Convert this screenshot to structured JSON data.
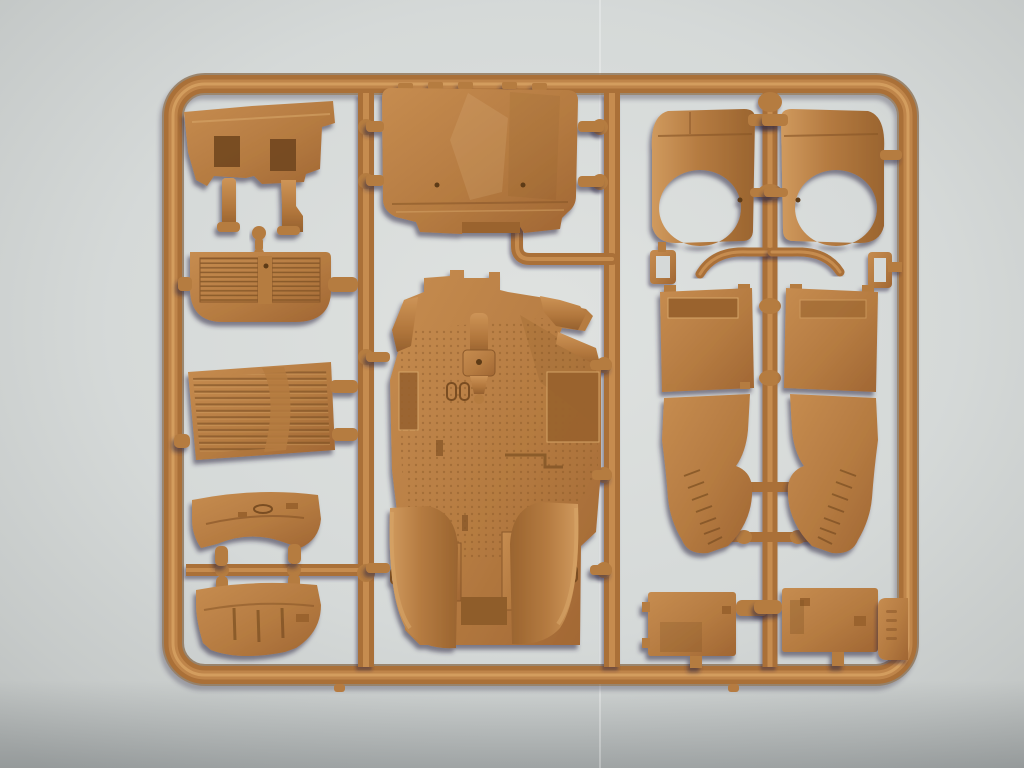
{
  "scene": {
    "subject": "tan plastic model-kit sprue (parts tree) photographed on light grey paper",
    "columns": 3
  },
  "colors": {
    "background": "#cfd3d2",
    "background_light": "#dfe2e0",
    "background_dark": "#b9bdbc",
    "plastic_base": "#b57b41",
    "plastic_mid": "#aa7038",
    "plastic_light": "#cd9457",
    "plastic_highlight": "#d6a162",
    "plastic_dark": "#8a5829",
    "plastic_edge": "#6d441f",
    "recess_dark": "#7a4e22",
    "cast_shadow": "#2e2545"
  },
  "sprue_tag": {
    "embossed_marks": 4,
    "legible": "no"
  },
  "parts": [
    {
      "name": "firewall-panel"
    },
    {
      "name": "mounting-pin"
    },
    {
      "name": "radiator-grille"
    },
    {
      "name": "louvered-panel"
    },
    {
      "name": "hull-plate-upper"
    },
    {
      "name": "hull-plate-lower"
    },
    {
      "name": "body-shell"
    },
    {
      "name": "chassis-tub"
    },
    {
      "name": "front-fender-left"
    },
    {
      "name": "front-fender-right"
    },
    {
      "name": "shackle-left"
    },
    {
      "name": "shackle-right"
    },
    {
      "name": "grab-handle-left"
    },
    {
      "name": "grab-handle-right"
    },
    {
      "name": "side-panel-left"
    },
    {
      "name": "side-panel-right"
    },
    {
      "name": "rear-mudguard-left"
    },
    {
      "name": "rear-mudguard-right"
    },
    {
      "name": "hatch-left"
    },
    {
      "name": "hatch-right"
    },
    {
      "name": "sprue-tag"
    }
  ]
}
